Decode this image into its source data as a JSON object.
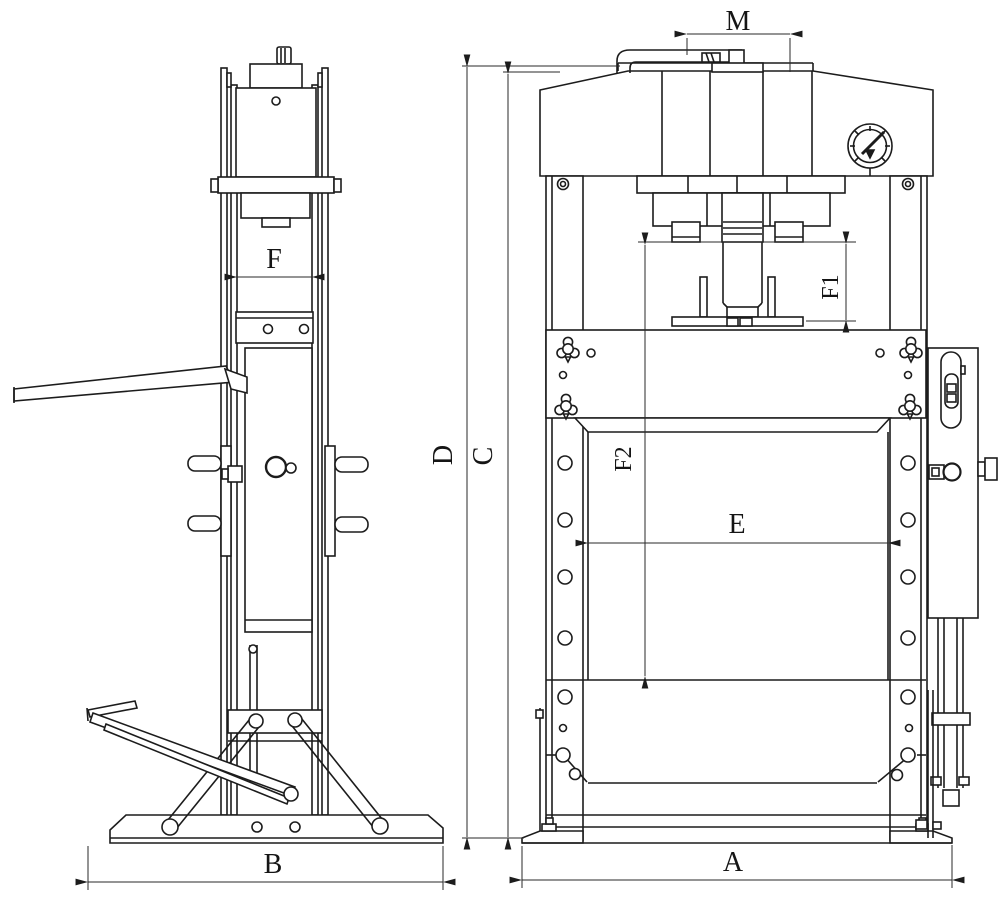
{
  "drawing": {
    "type": "technical-two-view-drawing",
    "subject": "hydraulic-shop-press",
    "background_color": "#ffffff",
    "line_color": "#1c1c1c",
    "labels": {
      "M": "M",
      "F": "F",
      "F1": "F1",
      "F2": "F2",
      "D": "D",
      "C": "C",
      "E": "E",
      "B": "B",
      "A": "A"
    }
  }
}
